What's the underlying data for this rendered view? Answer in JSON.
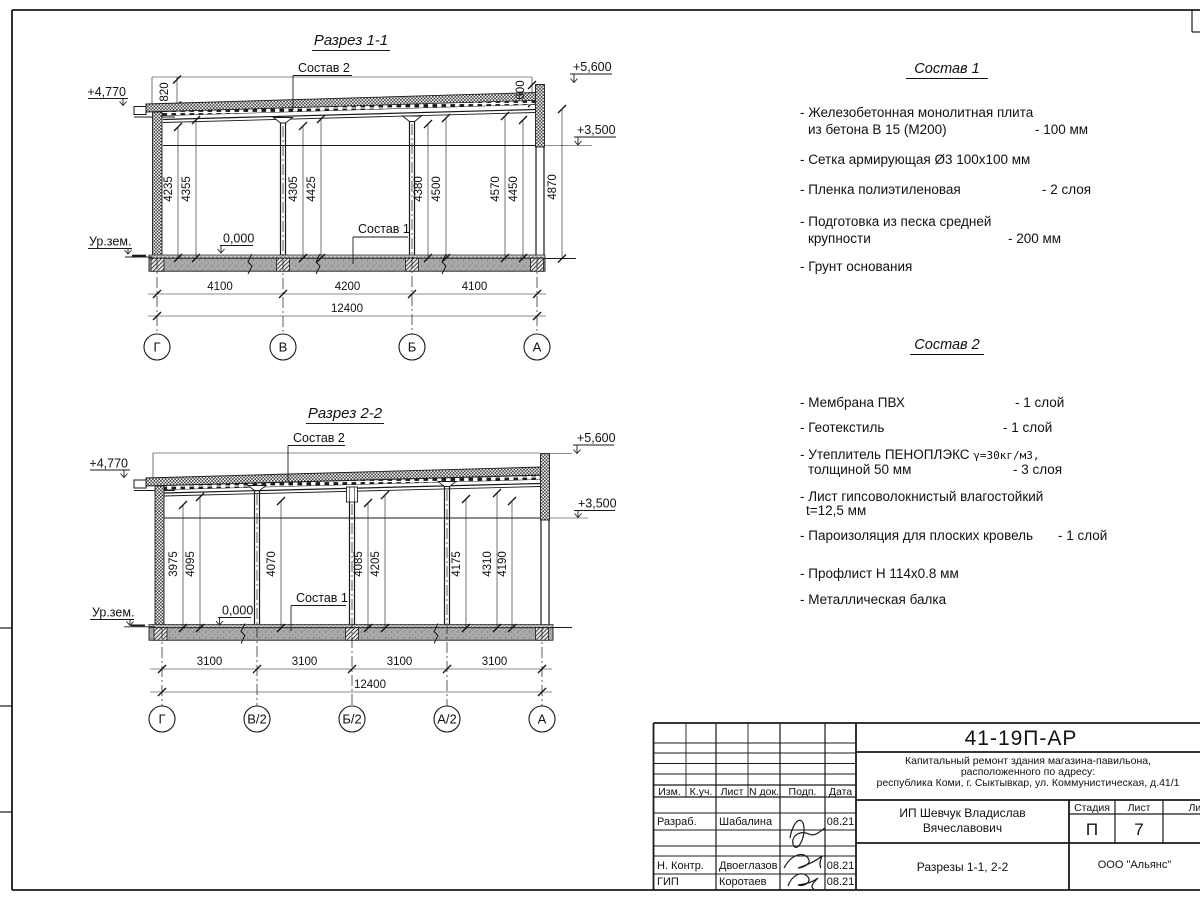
{
  "s1": {
    "title": "Разрез 1-1",
    "grids": [
      "Г",
      "В",
      "Б",
      "А"
    ],
    "spans": [
      "4100",
      "4200",
      "4100"
    ],
    "total": "12400",
    "vdims": [
      "4235",
      "4355",
      "4305",
      "4425",
      "4380",
      "4500",
      "4570",
      "4450",
      "4870"
    ],
    "dim_left": "820",
    "dim_right": "600",
    "elev_eave": "+4,770",
    "elev_top": "+5,600",
    "elev_mid": "+3,500",
    "zero": "0,000",
    "ground": "Ур.зем.",
    "sostav1_ref": "Состав 1",
    "sostav2_ref": "Состав 2"
  },
  "s2": {
    "title": "Разрез 2-2",
    "grids": [
      "Г",
      "В/2",
      "Б/2",
      "А/2",
      "А"
    ],
    "spans": [
      "3100",
      "3100",
      "3100",
      "3100"
    ],
    "total": "12400",
    "vdims": [
      "3975",
      "4095",
      "4070",
      "4085",
      "4205",
      "4175",
      "4310",
      "4190"
    ],
    "elev_eave": "+4,770",
    "elev_top": "+5,600",
    "elev_mid": "+3,500",
    "zero": "0,000",
    "ground": "Ур.зем.",
    "sostav1_ref": "Состав 1",
    "sostav2_ref": "Состав 2"
  },
  "sostav1": {
    "title": "Состав 1",
    "i1_l1": "- Железобетонная  монолитная плита",
    "i1_l2": "из бетона В 15 (М200)",
    "i1_v": "- 100 мм",
    "i2_l1": "- Сетка армирующая Ø3 100х100 мм",
    "i3_l1": "- Пленка полиэтиленовая",
    "i3_v": "- 2 слоя",
    "i4_l1": "- Подготовка из песка средней",
    "i4_l2": "крупности",
    "i4_v": "- 200 мм",
    "i5_l1": "- Грунт основания"
  },
  "sostav2": {
    "title": "Состав 2",
    "i1_l1": "- Мембрана ПВХ",
    "i1_v": "- 1 слой",
    "i2_l1": "- Геотекстиль",
    "i2_v": "- 1 слой",
    "i3_l1": "- Утеплитель ПЕНОПЛЭКС",
    "i3_l1b": "γ=30кг/м3,",
    "i3_l2": "толщиной 50 мм",
    "i3_v": "- 3 слоя",
    "i4_l1": "- Лист гипсоволокнистый влагостойкий",
    "i4_l2": "t=12,5 мм",
    "i5_l1": "- Пароизоляция для плоских кровель",
    "i5_v": "- 1 слой",
    "i6_l1": "- Профлист Н 114х0.8 мм",
    "i7_l1": "- Металлическая балка"
  },
  "titleblock": {
    "doc_number": "41-19П-АР",
    "desc_line1": "Капитальный ремонт здания магазина-павильона,",
    "desc_line2": "расположенного по адресу:",
    "desc_line3": "республика Коми, г. Сыктывкар, ул. Коммунистическая, д.41/1",
    "client_line1": "ИП Шевчук Владислав",
    "client_line2": "Вячеславович",
    "sheet_title": "Разрезы 1-1, 2-2",
    "org": "ООО \"Альянс\"",
    "col_izm": "Изм.",
    "col_kuch": "К.уч.",
    "col_list": "Лист",
    "col_ndoc": "N док.",
    "col_podp": "Подп.",
    "col_data": "Дата",
    "row1_role": "Разраб.",
    "row1_name": "Шабалина",
    "row1_date": "08.21",
    "row2_role": "Н. Контр.",
    "row2_name": "Двоеглазов",
    "row2_date": "08.21",
    "row3_role": "ГИП",
    "row3_name": "Коротаев",
    "row3_date": "08.21",
    "stage_label": "Стадия",
    "list_label": "Лист",
    "listov_label": "Листов",
    "stage_value": "П",
    "list_value": "7"
  }
}
